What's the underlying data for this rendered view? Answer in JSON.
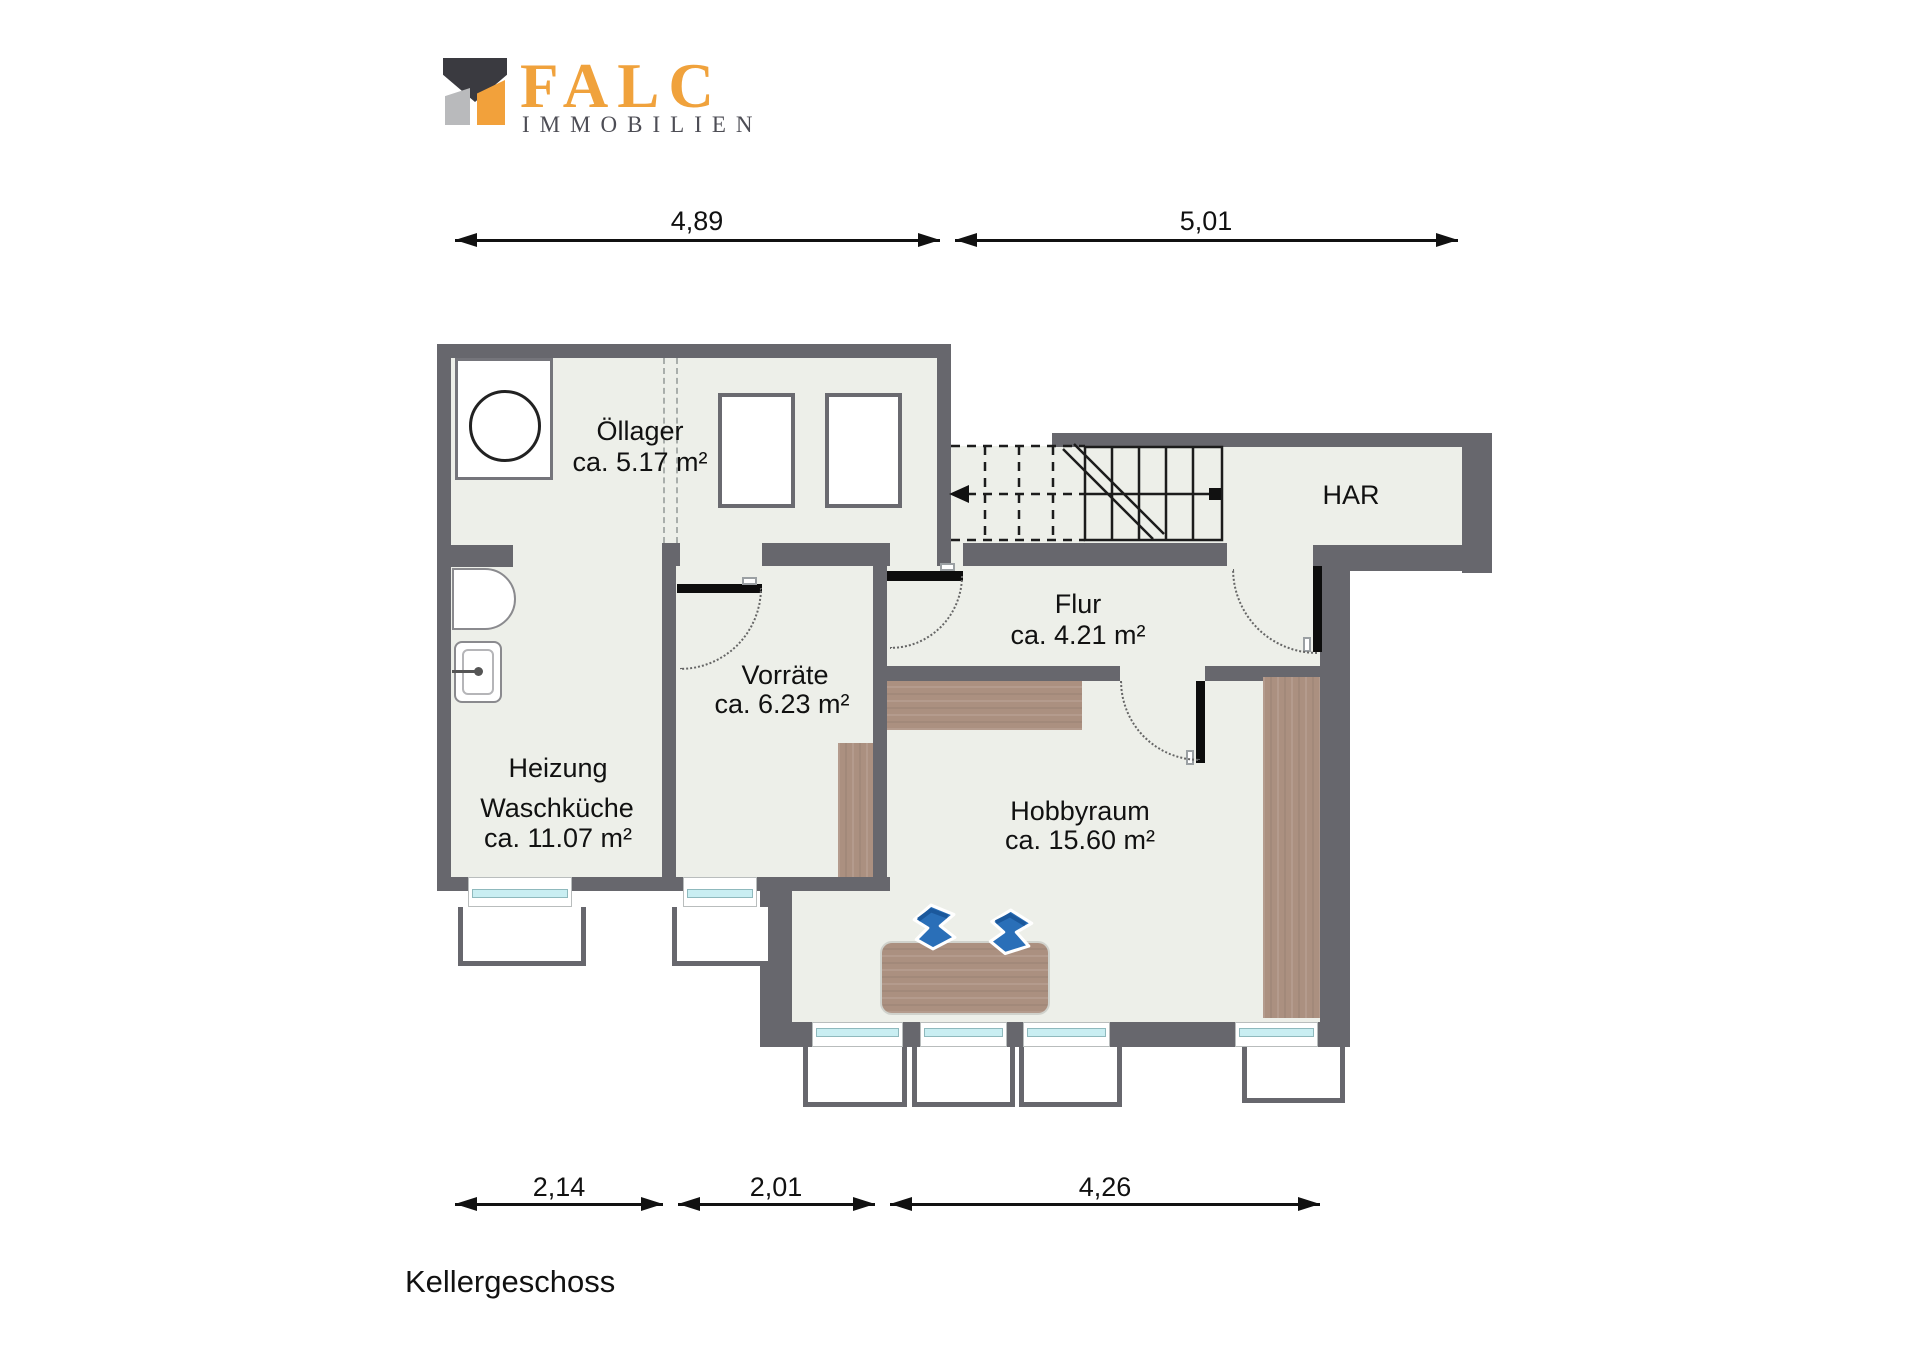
{
  "logo": {
    "brand": "FALC",
    "subtitle": "IMMOBILIEN"
  },
  "dimensions_top": [
    {
      "label": "4,89"
    },
    {
      "label": "5,01"
    }
  ],
  "dimensions_bottom": [
    {
      "label": "2,14"
    },
    {
      "label": "2,01"
    },
    {
      "label": "4,26"
    }
  ],
  "rooms": {
    "oellager": {
      "name": "Öllager",
      "area": "ca. 5.17 m²"
    },
    "har": {
      "name": "HAR"
    },
    "flur": {
      "name": "Flur",
      "area": "ca. 4.21 m²"
    },
    "vorraete": {
      "name": "Vorräte",
      "area": "ca. 6.23 m²"
    },
    "heizung": {
      "name": "Heizung",
      "name2": "Waschküche",
      "area": "ca. 11.07 m²"
    },
    "hobbyraum": {
      "name": "Hobbyraum",
      "area": "ca. 15.60 m²"
    }
  },
  "floor_label": "Kellergeschoss",
  "icons": {
    "logo_mark": "falc-roof-mark",
    "washing_machine": "washing-machine-icon",
    "sink": "sink-icon",
    "counter": "basin-counter-icon",
    "oil_tanks": "oil-tank-icon",
    "stairs": "staircase-icon",
    "desk": "desk-icon",
    "chairs": "office-chair-icon",
    "wardrobe": "wardrobe-icon",
    "sideboard": "sideboard-icon",
    "shelf": "shelf-icon"
  },
  "colors": {
    "wall": "#67676d",
    "floor": "#edefe9",
    "wood": "#ab9080",
    "accent_orange": "#f0a23c",
    "chair_blue": "#2a6fb8",
    "window_glass": "#c9eef2",
    "line": "#111111"
  }
}
